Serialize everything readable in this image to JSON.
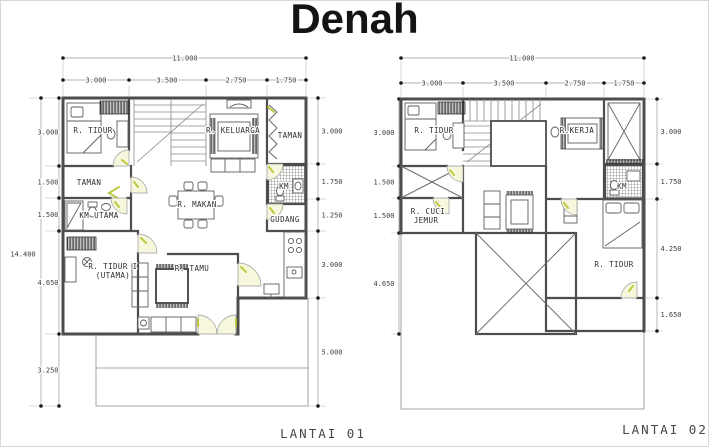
{
  "title": "Denah",
  "colors": {
    "wall_line": "#4d4d4d",
    "door_accent": "#b9c32e",
    "dim_text": "#3d3d3d",
    "background": "#ffffff"
  },
  "plan1": {
    "label": "LANTAI 01",
    "dims": {
      "total_w": "11.000",
      "total_h": "14.400",
      "top": [
        "3.000",
        "3.500",
        "2.750",
        "1.750"
      ],
      "left": [
        "3.000",
        "1.500",
        "1.500",
        "4.650",
        "3.250"
      ],
      "right": [
        "3.000",
        "1.750",
        "1.250",
        "3.000",
        "5.000"
      ]
    },
    "rooms": {
      "bedroom": "R. TIDUR",
      "family_room": "R. KELUARGA",
      "garden_right": "TAMAN",
      "garden_left": "TAMAN",
      "main_bath": "KM UTAMA",
      "bath": "KM",
      "storage": "GUDANG",
      "dining_room": "R. MAKAN",
      "master_bedroom_1": "R. TIDUR I",
      "master_bedroom_2": "(UTAMA)",
      "living_room": "R. TAMU"
    }
  },
  "plan2": {
    "label": "LANTAI 02",
    "dims": {
      "total_w": "11.000",
      "top": [
        "3.000",
        "3.500",
        "2.750",
        "1.750"
      ],
      "left": [
        "3.000",
        "1.500",
        "1.500",
        "4.650"
      ],
      "right": [
        "3.000",
        "1.750",
        "4.250",
        "1.650"
      ]
    },
    "rooms": {
      "bedroom": "R. TIDUR",
      "laundry_1": "R. CUCI",
      "laundry_2": "JEMUR",
      "work_room": "R.KERJA",
      "bath": "KM",
      "bedroom_right": "R. TIDUR"
    }
  }
}
